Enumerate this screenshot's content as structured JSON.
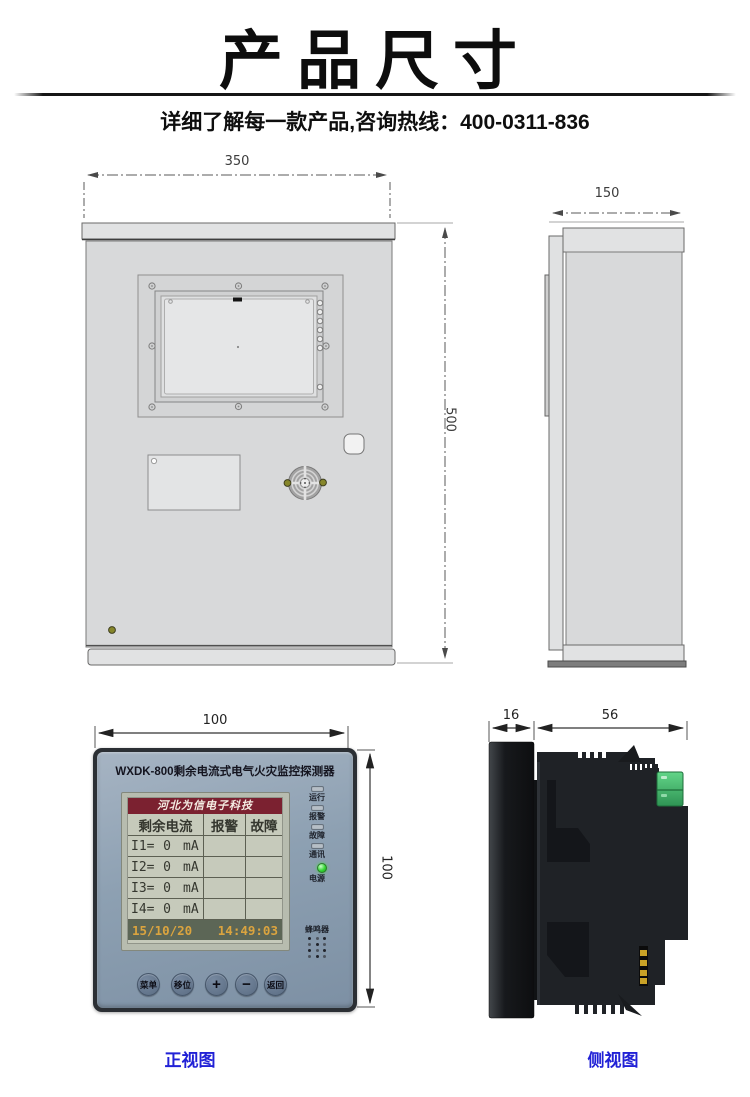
{
  "header": {
    "title": "产品尺寸",
    "subtitle": "详细了解每一款产品,咨询热线：400-0311-836"
  },
  "cabinet_front": {
    "width_mm": "350",
    "height_mm": "500"
  },
  "cabinet_side": {
    "depth_mm": "150"
  },
  "device_front": {
    "width_mm": "100",
    "height_mm": "100",
    "title": "WXDK-800剩余电流式电气火灾监控探测器",
    "lcd": {
      "brand": "河北为信电子科技",
      "col_headers": [
        "剩余电流",
        "报警",
        "故障"
      ],
      "rows": [
        {
          "ch": "I1=",
          "val": "0",
          "unit": "mA"
        },
        {
          "ch": "I2=",
          "val": "0",
          "unit": "mA"
        },
        {
          "ch": "I3=",
          "val": "0",
          "unit": "mA"
        },
        {
          "ch": "I4=",
          "val": "0",
          "unit": "mA"
        }
      ],
      "date": "15/10/20",
      "time": "14:49:03"
    },
    "leds": [
      {
        "label": "运行"
      },
      {
        "label": "报警"
      },
      {
        "label": "故障"
      },
      {
        "label": "通讯"
      },
      {
        "label": "电源",
        "state": "on"
      }
    ],
    "buzzer_label": "蜂鸣器",
    "buttons": [
      "菜单",
      "移位",
      "+",
      "−",
      "返回"
    ]
  },
  "device_side": {
    "bezel_mm": "16",
    "body_mm": "56"
  },
  "captions": {
    "front": "正视图",
    "side": "侧视图"
  },
  "colors": {
    "caption_blue": "#2121d6",
    "cabinet_gray": "#d8d9da",
    "device_face_blue_gray": "#8da0b2",
    "lcd_background": "#c6cabb",
    "lcd_header_maroon": "#7b2130",
    "lcd_footer_text_orange": "#dba43f",
    "power_led_green": "#34d634",
    "terminal_block_green": "#3fae5c",
    "pin_gold": "#c9a227"
  }
}
